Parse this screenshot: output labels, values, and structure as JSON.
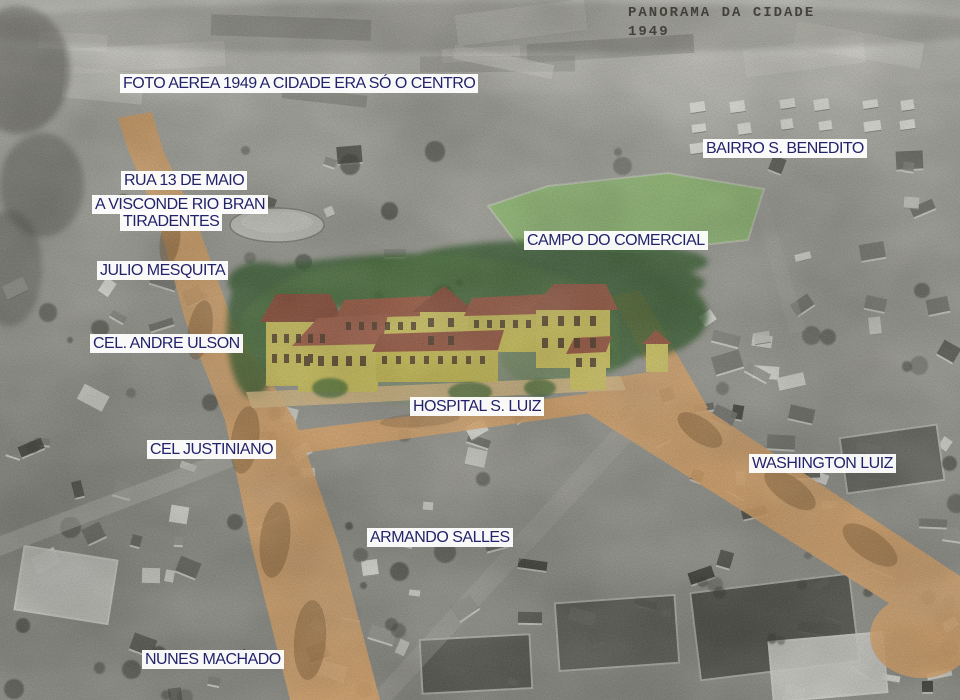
{
  "stamp": {
    "line1": "PANORAMA DA CIDADE",
    "line2": "1949"
  },
  "labels": {
    "caption": "FOTO AEREA 1949 A CIDADE ERA SÓ O CENTRO",
    "bairro_s_benedito": "BAIRRO S. BENEDITO",
    "rua_13_de_maio": "RUA 13 DE MAIO",
    "visconde_rio_branco": "A VISCONDE RIO BRAN",
    "tiradentes": "TIRADENTES",
    "campo_do_comercial": "CAMPO DO COMERCIAL",
    "julio_mesquita": "JULIO MESQUITA",
    "cel_andre_ulson": "CEL. ANDRE ULSON",
    "hospital_s_luiz": "HOSPITAL S. LUIZ",
    "cel_justiniano": "CEL JUSTINIANO",
    "washington_luiz": "WASHINGTON LUIZ",
    "armando_salles": "ARMANDO SALLES",
    "nunes_machado": "NUNES MACHADO"
  },
  "highlights": {
    "roads_color": "#e2a868",
    "field_color": "#93c472",
    "trees_color": "#2e5a28",
    "hospital_wall_color": "#d6ca5e",
    "hospital_roof_color": "#9b5a42",
    "label_bg": "#ffffff",
    "label_text": "#23236b"
  }
}
